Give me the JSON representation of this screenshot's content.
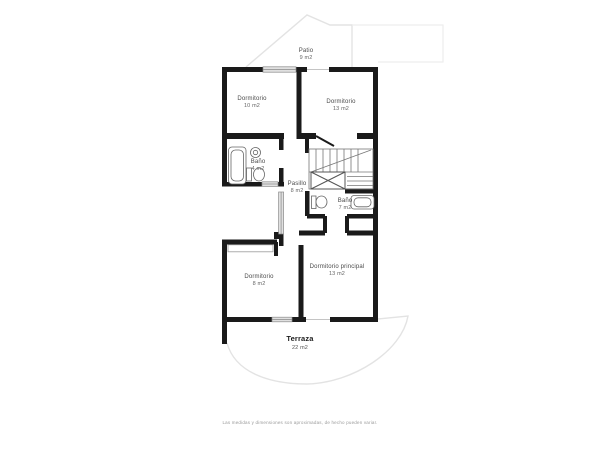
{
  "rooms": [
    {
      "name": "Patio",
      "area": "9 m2"
    },
    {
      "name": "Dormitorio",
      "area": "10 m2"
    },
    {
      "name": "Dormitorio",
      "area": "13 m2"
    },
    {
      "name": "Baño",
      "area": "4 m2"
    },
    {
      "name": "Pasillo",
      "area": "8 m2"
    },
    {
      "name": "Baño",
      "area": "7 m2"
    },
    {
      "name": "Dormitorio",
      "area": "8 m2"
    },
    {
      "name": "Dormitorio principal",
      "area": "13 m2"
    },
    {
      "name": "Terraza",
      "area": "22 m2"
    }
  ],
  "footer": {
    "disclaimer": "Las medidas y dimensiones son aproximadas, de hecho pueden variar."
  },
  "colors": {
    "wall": "#1a1a1a",
    "light_outline": "#e3e3e3",
    "window_fill": "#e0e0e0",
    "fixture_stroke": "#666666",
    "label_text": "#4a4a4a"
  }
}
